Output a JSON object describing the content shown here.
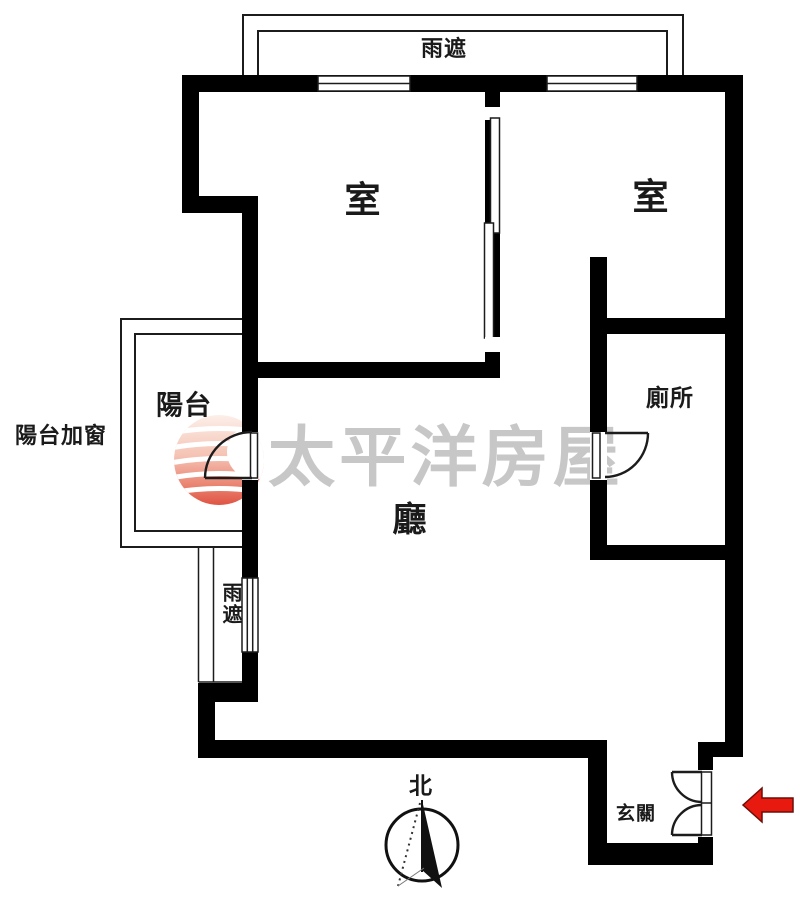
{
  "labels": {
    "canopy_top": "雨遮",
    "canopy_left": "雨遮",
    "bedroom_left": "室",
    "bedroom_right": "室",
    "balcony": "陽台",
    "balcony_note": "陽台加窗",
    "living_room": "廳",
    "toilet": "廁所",
    "entrance": "玄關",
    "compass_north": "北",
    "watermark": "太平洋房屋"
  },
  "colors": {
    "wall": "#000000",
    "line": "#1c1c1c",
    "watermark_text": "#c7c7c7",
    "logo_top": "#fcefe9",
    "logo_mid": "#f5c3b4",
    "logo_deep": "#e05443",
    "arrow_red": "#e8190f",
    "background": "#ffffff"
  }
}
